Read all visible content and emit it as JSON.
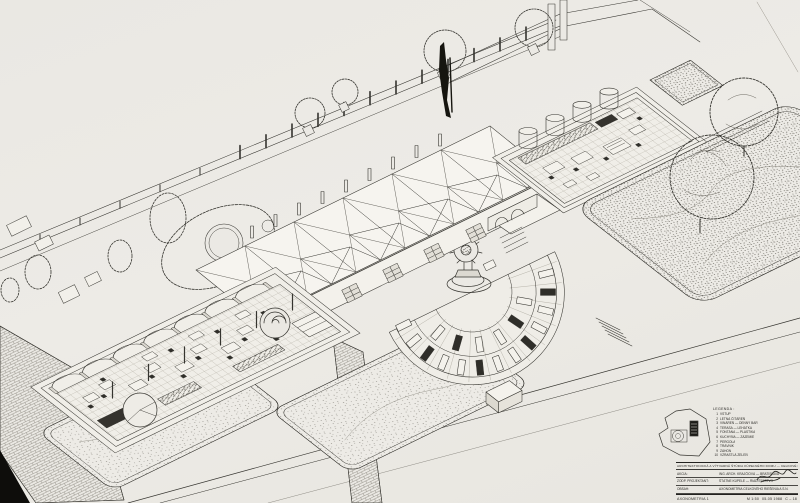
{
  "page": {
    "paper_color": "#ebe9e4",
    "ink_color": "#2b2a27"
  },
  "legend": {
    "header": "LEGENDA :",
    "items": [
      {
        "num": "1",
        "label": "VSTUP"
      },
      {
        "num": "2",
        "label": "LETNÁ ČITÁREŇ"
      },
      {
        "num": "3",
        "label": "VINÁREŇ — DENNÝ BAR"
      },
      {
        "num": "4",
        "label": "TERASA — LEHÁTKA"
      },
      {
        "num": "5",
        "label": "FONTÁNA — PLASTIKA"
      },
      {
        "num": "6",
        "label": "KUCHYŇA — ZÁZEMIE"
      },
      {
        "num": "7",
        "label": "PERGOLA"
      },
      {
        "num": "8",
        "label": "TRÁVNIK"
      },
      {
        "num": "9",
        "label": "ZÁHON"
      },
      {
        "num": "10",
        "label": "VZRASTLÁ ZELEŇ"
      }
    ]
  },
  "titleblock": {
    "project_title": "ARCHITEKTONICKÁ A VÝTVARNÁ ŠTÚDIA KÚPEĽNÉHO DOMU — CELKOVÉ RIEŠENIE",
    "rows": [
      {
        "label": "AKCIA:",
        "value": "ING. ARCH. KRAJČÍOVÁ — BRATISLAVA"
      },
      {
        "label": "ZODP. PROJEKTANT:",
        "value": "ŠTÁTNE KÚPELE — RIADITEĽSTVO"
      },
      {
        "label": "OBSAH:",
        "value": "AXONOMETRIA CELKOVÉHO RIEŠENIA A S.N."
      }
    ],
    "bottom": {
      "name": "AXONOMETRIA 1",
      "scale": "M 1:50",
      "date": "05-05 1988",
      "sheet": "C – 18"
    }
  }
}
